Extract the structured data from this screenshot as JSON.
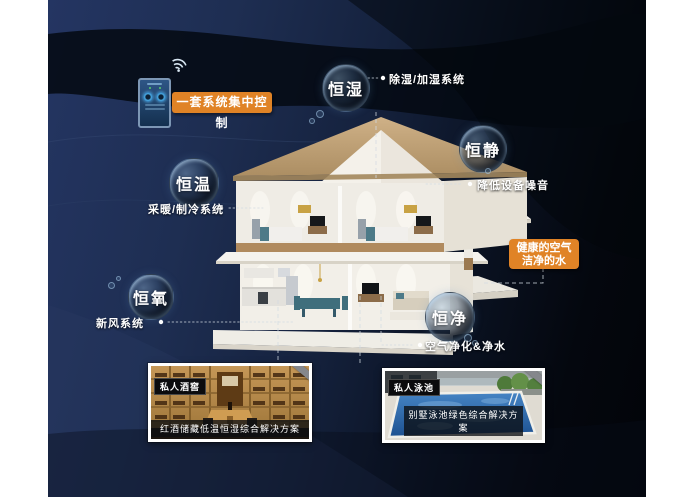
{
  "badges": {
    "control": "一套系统集中控制",
    "air_water_line1": "健康的空气",
    "air_water_line2": "洁净的水"
  },
  "bubbles": [
    {
      "label": "恒湿",
      "desc": "除湿/加湿系统"
    },
    {
      "label": "恒静",
      "desc": "降低设备噪音"
    },
    {
      "label": "恒温",
      "desc": "采暖/制冷系统"
    },
    {
      "label": "恒氧",
      "desc": "新风系统"
    },
    {
      "label": "恒净",
      "desc": "空气净化&净水"
    }
  ],
  "photos": [
    {
      "tag": "私人酒窖",
      "caption": "红酒储藏低温恒湿综合解决方案"
    },
    {
      "tag": "私人泳池",
      "caption": "别墅泳池绿色综合解决方案"
    }
  ],
  "colors": {
    "accent_orange": "#e08326",
    "background_navy": "#1e2f55",
    "background_black": "#04070e",
    "roof_tan": "#c3a67c",
    "pool_water": "#2f6fb4",
    "cellar_wood": "#b9833e"
  }
}
